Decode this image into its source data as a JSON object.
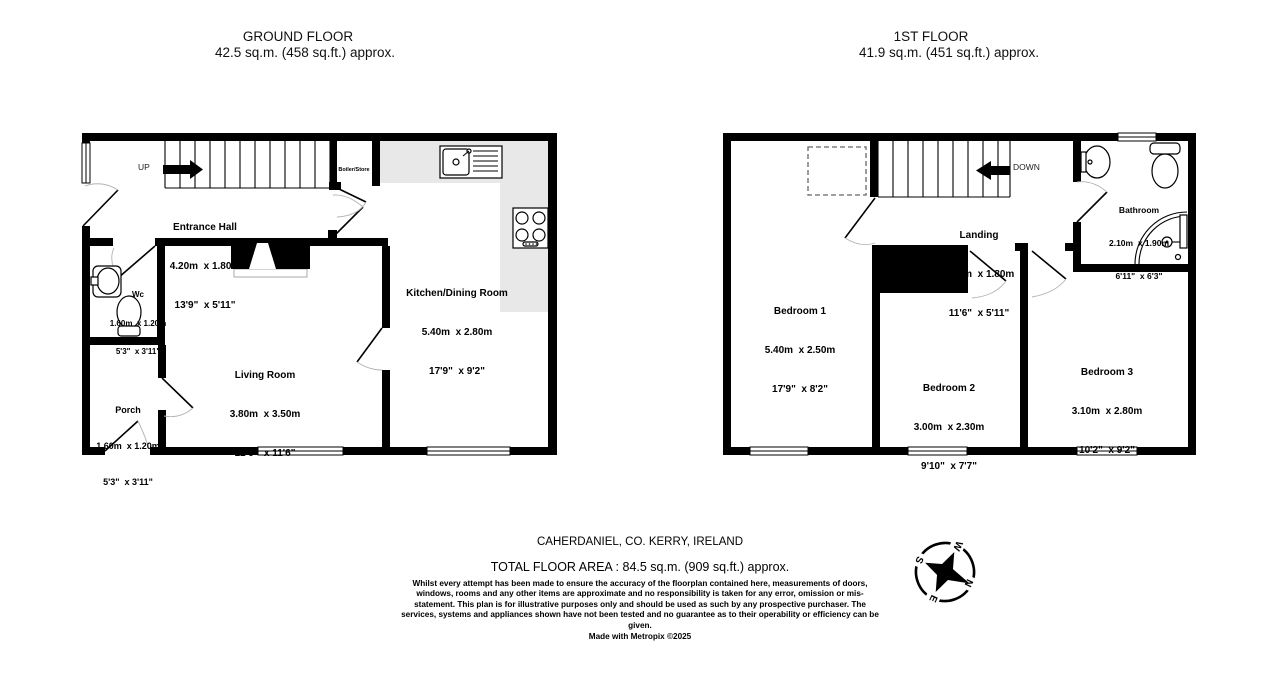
{
  "floors": {
    "ground": {
      "title": "GROUND FLOOR",
      "subtitle": "42.5 sq.m. (458 sq.ft.) approx.",
      "rooms": [
        {
          "name": "Entrance Hall",
          "metric": "4.20m  x 1.80m",
          "imperial": "13'9\"  x 5'11\""
        },
        {
          "name": "Wc",
          "metric": "1.60m  x 1.20m",
          "imperial": "5'3\"  x 3'11\""
        },
        {
          "name": "Porch",
          "metric": "1.60m  x 1.20m",
          "imperial": "5'3\"  x 3'11\""
        },
        {
          "name": "Living Room",
          "metric": "3.80m  x 3.50m",
          "imperial": "12'6\"  x 11'6\""
        },
        {
          "name": "Kitchen/Dining Room",
          "metric": "5.40m  x 2.80m",
          "imperial": "17'9\"  x 9'2\""
        }
      ],
      "stair_label": "UP",
      "store_label": "Boiler/Store"
    },
    "first": {
      "title": "1ST FLOOR",
      "subtitle": "41.9 sq.m. (451 sq.ft.) approx.",
      "rooms": [
        {
          "name": "Landing",
          "metric": "3.50m  x 1.80m",
          "imperial": "11'6\"  x 5'11\""
        },
        {
          "name": "Bathroom",
          "metric": "2.10m  x 1.90m",
          "imperial": "6'11\"  x 6'3\""
        },
        {
          "name": "Bedroom 1",
          "metric": "5.40m  x 2.50m",
          "imperial": "17'9\"  x 8'2\""
        },
        {
          "name": "Bedroom 2",
          "metric": "3.00m  x 2.30m",
          "imperial": "9'10\"  x 7'7\""
        },
        {
          "name": "Bedroom 3",
          "metric": "3.10m  x 2.80m",
          "imperial": "10'2\"  x 9'2\""
        }
      ],
      "stair_label": "DOWN"
    }
  },
  "footer": {
    "address": "CAHERDANIEL, CO. KERRY, IRELAND",
    "total_area": "TOTAL FLOOR AREA : 84.5 sq.m. (909 sq.ft.) approx.",
    "disclaimer": "Whilst every attempt has been made to ensure the accuracy of the floorplan contained here, measurements of doors, windows, rooms and any other items are approximate and no responsibility is taken for any error, omission or mis-statement. This plan is for illustrative purposes only and should be used as such by any prospective purchaser. The services, systems and appliances shown have not been tested and no guarantee as to their operability or efficiency can be given.",
    "credit": "Made with Metropix ©2025"
  },
  "compass": {
    "north": "N",
    "south": "S",
    "east": "E",
    "west": "W"
  },
  "colors": {
    "wall": "#000000",
    "counter": "#e8e8e8",
    "background": "#ffffff"
  }
}
